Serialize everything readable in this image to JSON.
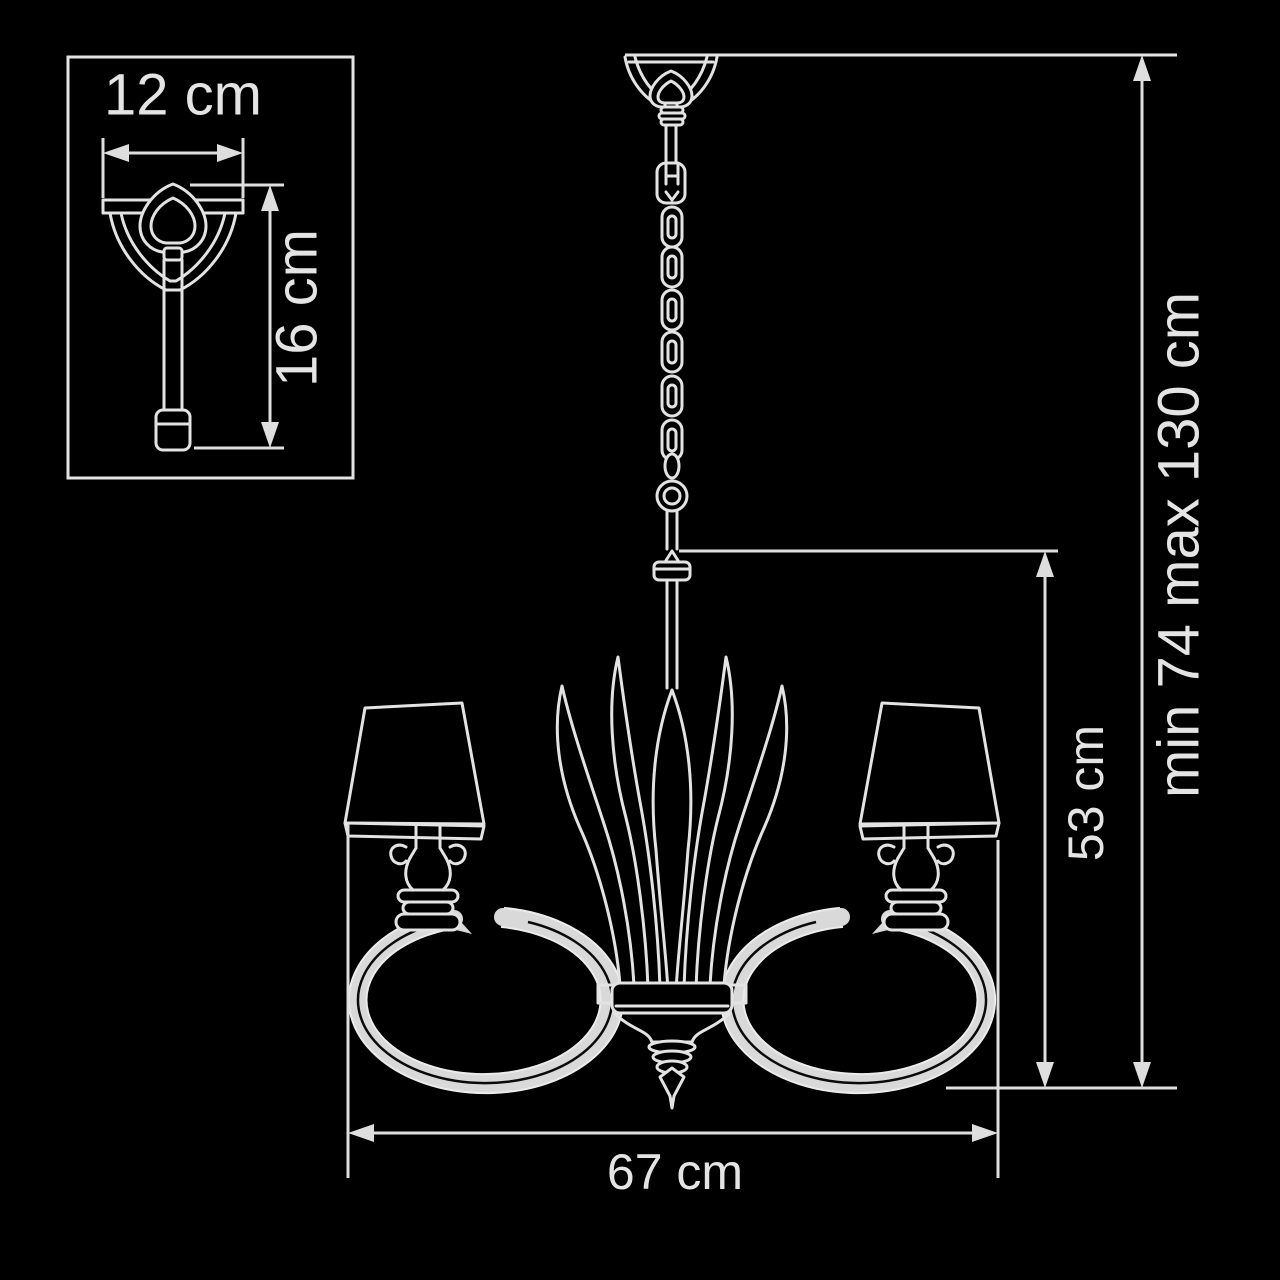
{
  "diagram": {
    "title": "chandelier-dimension-drawing",
    "inset": {
      "width_label": "12 cm",
      "height_label": "16 cm"
    },
    "dimensions": {
      "fixture_width_label": "67 cm",
      "fixture_height_label": "53 cm",
      "suspension_range_label": "min 74 max 130 cm"
    },
    "colors": {
      "background": "#000000",
      "line": "#e3e3e3",
      "dimension_line": "#dedede",
      "text": "#e4e4e4",
      "arm_fill": "#d9d9d9"
    }
  }
}
